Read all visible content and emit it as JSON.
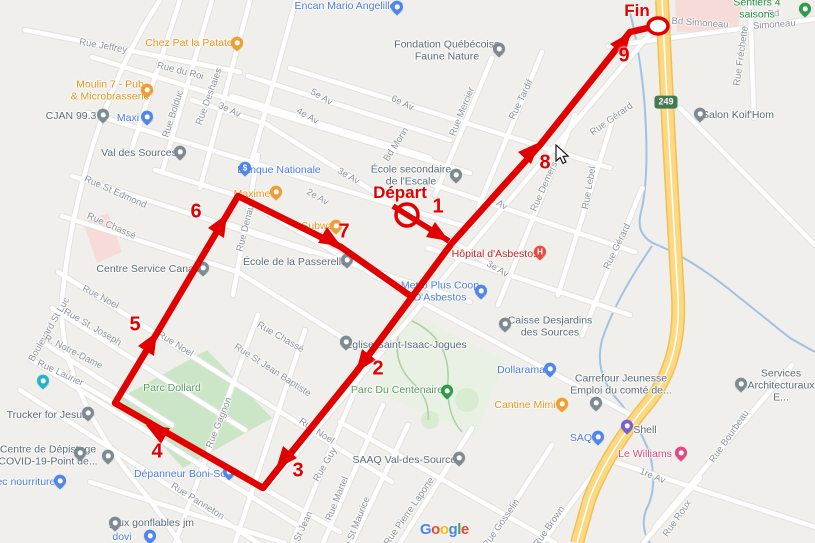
{
  "colors": {
    "land": "#f0efeb",
    "road": "#ffffff",
    "road_casing": "#e4e2de",
    "park": "#cbe6c6",
    "park_pale": "#e8f1e3",
    "trail": "#aecfa5",
    "water": "#9fc2e6",
    "highway": "#fdd880",
    "highway_casing": "#eec158",
    "pink_zone": "#f7dbd8",
    "route_red": "#e10000"
  },
  "route": {
    "start": {
      "label": "Départ",
      "x": 400,
      "y": 193
    },
    "end": {
      "label": "Fin",
      "x": 637,
      "y": 11
    },
    "waypoints": [
      {
        "n": "1",
        "x": 438,
        "y": 207
      },
      {
        "n": "2",
        "x": 378,
        "y": 369
      },
      {
        "n": "3",
        "x": 298,
        "y": 471
      },
      {
        "n": "4",
        "x": 157,
        "y": 452
      },
      {
        "n": "5",
        "x": 135,
        "y": 325
      },
      {
        "n": "6",
        "x": 196,
        "y": 212
      },
      {
        "n": "7",
        "x": 344,
        "y": 232
      },
      {
        "n": "8",
        "x": 545,
        "y": 163
      },
      {
        "n": "9",
        "x": 624,
        "y": 56
      }
    ]
  },
  "highway_shield": {
    "text": "249"
  },
  "attribution": {
    "letters": [
      {
        "ch": "G",
        "color": "#4285F4"
      },
      {
        "ch": "o",
        "color": "#EA4335"
      },
      {
        "ch": "o",
        "color": "#FBBC05"
      },
      {
        "ch": "g",
        "color": "#4285F4"
      },
      {
        "ch": "l",
        "color": "#34A853"
      },
      {
        "ch": "e",
        "color": "#EA4335"
      }
    ]
  },
  "markers": [
    {
      "name": "encan-mario-angelillo",
      "x": 397,
      "y": 9,
      "color": "#4e86ec",
      "glyph": ""
    },
    {
      "name": "chez-pat-la-patate",
      "x": 237,
      "y": 45,
      "color": "#f09e2e",
      "glyph": ""
    },
    {
      "name": "moulin-7-pub",
      "x": 147,
      "y": 92,
      "color": "#f09e2e",
      "glyph": ""
    },
    {
      "name": "cjan-99-3",
      "x": 103,
      "y": 117,
      "color": "#7b8a93",
      "glyph": ""
    },
    {
      "name": "maxi",
      "x": 147,
      "y": 119,
      "color": "#4e86ec",
      "glyph": ""
    },
    {
      "name": "val-des-sources",
      "x": 180,
      "y": 154,
      "color": "#7b8a93",
      "glyph": ""
    },
    {
      "name": "fondation-quebecoise-faune-nature",
      "x": 499,
      "y": 51,
      "color": "#7b8a93",
      "glyph": ""
    },
    {
      "name": "sentiers-4-saisons",
      "x": 805,
      "y": 11,
      "color": "#2c9c47",
      "glyph": ""
    },
    {
      "name": "salon-koif-hom",
      "x": 700,
      "y": 116,
      "color": "#7b8a93",
      "glyph": ""
    },
    {
      "name": "ecole-secondaire-de-l-escale",
      "x": 456,
      "y": 177,
      "color": "#7b8a93",
      "glyph": ""
    },
    {
      "name": "banque-nationale",
      "x": 245,
      "y": 170,
      "color": "#4e86ec",
      "glyph": "$"
    },
    {
      "name": "maxime",
      "x": 276,
      "y": 194,
      "color": "#f09e2e",
      "glyph": ""
    },
    {
      "name": "subway",
      "x": 336,
      "y": 228,
      "color": "#f09e2e",
      "glyph": ""
    },
    {
      "name": "ecole-de-la-passerelle",
      "x": 347,
      "y": 262,
      "color": "#7b8a93",
      "glyph": ""
    },
    {
      "name": "hopital-d-asbestos",
      "x": 540,
      "y": 254,
      "color": "#ea4a3f",
      "glyph": "H"
    },
    {
      "name": "metro-plus-coop",
      "x": 481,
      "y": 293,
      "color": "#4e86ec",
      "glyph": ""
    },
    {
      "name": "centre-service-canada",
      "x": 203,
      "y": 270,
      "color": "#7b8a93",
      "glyph": ""
    },
    {
      "name": "caisse-desjardins-des-sources",
      "x": 505,
      "y": 326,
      "color": "#7b8a93",
      "glyph": ""
    },
    {
      "name": "dollarama",
      "x": 550,
      "y": 371,
      "color": "#4e86ec",
      "glyph": ""
    },
    {
      "name": "carrefour-jeunesse-emploi",
      "x": 596,
      "y": 405,
      "color": "#7b8a93",
      "glyph": ""
    },
    {
      "name": "cantine-mimi",
      "x": 562,
      "y": 406,
      "color": "#f09e2e",
      "glyph": ""
    },
    {
      "name": "saq",
      "x": 598,
      "y": 439,
      "color": "#4e86ec",
      "glyph": ""
    },
    {
      "name": "shell",
      "x": 627,
      "y": 428,
      "color": "#7460d1",
      "glyph": ""
    },
    {
      "name": "le-williams",
      "x": 681,
      "y": 455,
      "color": "#e5477f",
      "glyph": ""
    },
    {
      "name": "services-architecturaux",
      "x": 741,
      "y": 386,
      "color": "#7b8a93",
      "glyph": ""
    },
    {
      "name": "trucker-for-jesus",
      "x": 88,
      "y": 415,
      "color": "#7b8a93",
      "glyph": ""
    },
    {
      "name": "centre-de-depistage-covid",
      "x": 80,
      "y": 455,
      "color": "#7b8a93",
      "glyph": ""
    },
    {
      "name": "school-unlabeled",
      "x": 108,
      "y": 458,
      "color": "#7b8a93",
      "glyph": ""
    },
    {
      "name": "bec-nourriture",
      "x": 60,
      "y": 483,
      "color": "#4e86ec",
      "glyph": ""
    },
    {
      "name": "depanneur-boni-soir",
      "x": 229,
      "y": 474,
      "color": "#4e86ec",
      "glyph": ""
    },
    {
      "name": "jeux-gonflables-jm",
      "x": 115,
      "y": 525,
      "color": "#7b8a93",
      "glyph": ""
    },
    {
      "name": "dovi",
      "x": 150,
      "y": 538,
      "color": "#4e86ec",
      "glyph": ""
    },
    {
      "name": "unlabeled-teal",
      "x": 43,
      "y": 383,
      "color": "#1fb6c9",
      "glyph": ""
    },
    {
      "name": "saaq-val-des-sources",
      "x": 459,
      "y": 460,
      "color": "#7b8a93",
      "glyph": ""
    },
    {
      "name": "eglise-saint-isaac-jogues",
      "x": 346,
      "y": 344,
      "color": "#7b8a93",
      "glyph": ""
    },
    {
      "name": "parc-du-centenaire-tree",
      "x": 447,
      "y": 393,
      "color": "#2c9c47",
      "glyph": ""
    }
  ],
  "labels": [
    {
      "t": "Rue Jeffrey",
      "x": 103,
      "y": 47,
      "r": 10,
      "c": "street"
    },
    {
      "t": "Rue du Roi",
      "x": 180,
      "y": 72,
      "r": 14,
      "c": "street"
    },
    {
      "t": "Rue Bolduc",
      "x": 174,
      "y": 114,
      "r": -72,
      "c": "street"
    },
    {
      "t": "Rue Deshaies",
      "x": 210,
      "y": 97,
      "r": -70,
      "c": "street"
    },
    {
      "t": "3e Av",
      "x": 229,
      "y": 111,
      "r": 25,
      "c": "street"
    },
    {
      "t": "5e Av",
      "x": 321,
      "y": 98,
      "r": 30,
      "c": "street"
    },
    {
      "t": "4e Av",
      "x": 307,
      "y": 117,
      "r": 30,
      "c": "street"
    },
    {
      "t": "6e Av",
      "x": 402,
      "y": 104,
      "r": 25,
      "c": "street"
    },
    {
      "t": "Bd Morin",
      "x": 397,
      "y": 145,
      "r": -57,
      "c": "street"
    },
    {
      "t": "Rue Mercier",
      "x": 463,
      "y": 112,
      "r": -68,
      "c": "street"
    },
    {
      "t": "Rue Tardif",
      "x": 522,
      "y": 100,
      "r": -64,
      "c": "street"
    },
    {
      "t": "Bd Simoneau",
      "x": 700,
      "y": 24,
      "r": 4,
      "c": "street"
    },
    {
      "t": "Bd Simoneau",
      "x": 774,
      "y": 20,
      "r": -4,
      "c": "street"
    },
    {
      "t": "Rue Fréchette",
      "x": 742,
      "y": 56,
      "r": -82,
      "c": "street"
    },
    {
      "t": "Rue Gérard",
      "x": 612,
      "y": 120,
      "r": -35,
      "c": "street"
    },
    {
      "t": "Rue Gérard",
      "x": 618,
      "y": 247,
      "r": -64,
      "c": "street"
    },
    {
      "t": "Rue Demers",
      "x": 545,
      "y": 187,
      "r": -66,
      "c": "street"
    },
    {
      "t": "Rue Lebel",
      "x": 590,
      "y": 188,
      "r": -80,
      "c": "street"
    },
    {
      "t": "e Av",
      "x": 498,
      "y": 204,
      "r": 30,
      "c": "street"
    },
    {
      "t": "3e Av",
      "x": 348,
      "y": 177,
      "r": 30,
      "c": "street"
    },
    {
      "t": "2e Av",
      "x": 317,
      "y": 198,
      "r": 30,
      "c": "street"
    },
    {
      "t": "3e Av",
      "x": 497,
      "y": 270,
      "r": 30,
      "c": "street"
    },
    {
      "t": "Rue St Edmond",
      "x": 115,
      "y": 193,
      "r": 24,
      "c": "street"
    },
    {
      "t": "Rue Chassé",
      "x": 111,
      "y": 227,
      "r": 24,
      "c": "street"
    },
    {
      "t": "Rue Denault",
      "x": 247,
      "y": 226,
      "r": -76,
      "c": "street"
    },
    {
      "t": "Rue Noel",
      "x": 100,
      "y": 298,
      "r": 28,
      "c": "street"
    },
    {
      "t": "Rue St. Joseph",
      "x": 92,
      "y": 328,
      "r": 30,
      "c": "street"
    },
    {
      "t": "Boulevard St Luc",
      "x": 50,
      "y": 330,
      "r": -60,
      "c": "street"
    },
    {
      "t": "R. Notre-Dame",
      "x": 73,
      "y": 353,
      "r": 27,
      "c": "street"
    },
    {
      "t": "Rue Laurier",
      "x": 60,
      "y": 374,
      "r": 25,
      "c": "street"
    },
    {
      "t": "Rue Noel",
      "x": 175,
      "y": 345,
      "r": 32,
      "c": "street"
    },
    {
      "t": "Rue Chassé",
      "x": 280,
      "y": 338,
      "r": 30,
      "c": "street"
    },
    {
      "t": "Rue St Jean Baptiste",
      "x": 272,
      "y": 371,
      "r": 33,
      "c": "street"
    },
    {
      "t": "Rue Gagnon",
      "x": 220,
      "y": 423,
      "r": -68,
      "c": "street"
    },
    {
      "t": "Rue Noel",
      "x": 316,
      "y": 432,
      "r": 33,
      "c": "street"
    },
    {
      "t": "Rue Guy",
      "x": 326,
      "y": 465,
      "r": -60,
      "c": "street"
    },
    {
      "t": "Rue Martel",
      "x": 338,
      "y": 499,
      "r": -68,
      "c": "street"
    },
    {
      "t": "Rue St Maurice",
      "x": 356,
      "y": 528,
      "r": -68,
      "c": "street"
    },
    {
      "t": "Rue Pierre Laporte",
      "x": 410,
      "y": 512,
      "r": -55,
      "c": "street"
    },
    {
      "t": "Rue Panneton",
      "x": 197,
      "y": 502,
      "r": 32,
      "c": "street"
    },
    {
      "t": "1re Av",
      "x": 652,
      "y": 477,
      "r": 22,
      "c": "street"
    },
    {
      "t": "Rue Roux",
      "x": 678,
      "y": 519,
      "r": -55,
      "c": "street"
    },
    {
      "t": "Rue Bourbeau",
      "x": 730,
      "y": 437,
      "r": -55,
      "c": "street"
    },
    {
      "t": "Rue Gosselin",
      "x": 502,
      "y": 524,
      "r": -55,
      "c": "street"
    },
    {
      "t": "Rue Brown",
      "x": 550,
      "y": 527,
      "r": -55,
      "c": "street"
    },
    {
      "t": "Rue St Jean",
      "x": 300,
      "y": 536,
      "r": -65,
      "c": "street"
    },
    {
      "t": "Encan Mario Angelillo",
      "x": 345,
      "y": 7,
      "r": 0,
      "c": "shop"
    },
    {
      "t": "Chez Pat la Patate",
      "x": 189,
      "y": 44,
      "r": 0,
      "c": "food"
    },
    {
      "t": "Moulin 7 - Pub\n& Microbrasserie",
      "x": 110,
      "y": 91,
      "r": 0,
      "c": "food"
    },
    {
      "t": "CJAN 99.3",
      "x": 71,
      "y": 117,
      "r": 0,
      "c": "poi"
    },
    {
      "t": "Maxi",
      "x": 128,
      "y": 119,
      "r": 0,
      "c": "shop"
    },
    {
      "t": "Val des Sources",
      "x": 139,
      "y": 154,
      "r": 0,
      "c": "poi"
    },
    {
      "t": "Fondation Québécoise\nFaune Nature",
      "x": 447,
      "y": 51,
      "r": 0,
      "c": "poi"
    },
    {
      "t": "Sentiers 4 saisons",
      "x": 757,
      "y": 9,
      "r": 0,
      "c": "green"
    },
    {
      "t": "Salon Koif'Hom",
      "x": 738,
      "y": 116,
      "r": 0,
      "c": "poi"
    },
    {
      "t": "École secondaire\nde l'Escale",
      "x": 411,
      "y": 176,
      "r": 0,
      "c": "poi"
    },
    {
      "t": "Banque Nationale",
      "x": 279,
      "y": 171,
      "r": 0,
      "c": "shop"
    },
    {
      "t": "Maxime",
      "x": 252,
      "y": 195,
      "r": 0,
      "c": "food"
    },
    {
      "t": "Subway",
      "x": 320,
      "y": 227,
      "r": 0,
      "c": "food"
    },
    {
      "t": "École de la Passerelle",
      "x": 295,
      "y": 263,
      "r": 0,
      "c": "poi"
    },
    {
      "t": "Hôpital d'Asbestos",
      "x": 495,
      "y": 255,
      "r": 0,
      "c": "hospital"
    },
    {
      "t": "Metro Plus Coop\nD'Asbestos",
      "x": 440,
      "y": 292,
      "r": 0,
      "c": "shop"
    },
    {
      "t": "Centre Service Canada",
      "x": 151,
      "y": 270,
      "r": 0,
      "c": "poi"
    },
    {
      "t": "Caisse Desjardins\ndes Sources",
      "x": 550,
      "y": 327,
      "r": 0,
      "c": "poi"
    },
    {
      "t": "Dollarama",
      "x": 521,
      "y": 371,
      "r": 0,
      "c": "shop"
    },
    {
      "t": "Carrefour Jeunesse\nEmploi du comté de...",
      "x": 621,
      "y": 385,
      "r": 0,
      "c": "poi"
    },
    {
      "t": "Cantine Mimi",
      "x": 525,
      "y": 406,
      "r": 0,
      "c": "food"
    },
    {
      "t": "SAQ",
      "x": 581,
      "y": 439,
      "r": 0,
      "c": "shop"
    },
    {
      "t": "Shell",
      "x": 645,
      "y": 431,
      "r": 0,
      "c": "poi"
    },
    {
      "t": "Le Williams",
      "x": 645,
      "y": 455,
      "r": 0,
      "c": "hotel"
    },
    {
      "t": "Services\nArchitecturaux E...",
      "x": 781,
      "y": 386,
      "r": 0,
      "c": "poi"
    },
    {
      "t": "Trucker for Jesus",
      "x": 47,
      "y": 416,
      "r": 0,
      "c": "poi"
    },
    {
      "t": "Centre de Dépistage\nCOVID-19-Point de...",
      "x": 48,
      "y": 456,
      "r": 0,
      "c": "poi"
    },
    {
      "t": "bec nourriture",
      "x": 23,
      "y": 483,
      "r": 0,
      "c": "shop"
    },
    {
      "t": "Dépanneur Boni-Soir",
      "x": 183,
      "y": 475,
      "r": 0,
      "c": "shop"
    },
    {
      "t": "jeux gonflables jm",
      "x": 152,
      "y": 524,
      "r": 0,
      "c": "poi"
    },
    {
      "t": "dovi",
      "x": 122,
      "y": 538,
      "r": 0,
      "c": "shop"
    },
    {
      "t": "Église Saint-Isaac-Jogues",
      "x": 406,
      "y": 346,
      "r": 0,
      "c": "poi"
    },
    {
      "t": "SAAQ Val-des-Sources",
      "x": 407,
      "y": 461,
      "r": 0,
      "c": "poi"
    },
    {
      "t": "Parc Dollard",
      "x": 172,
      "y": 389,
      "r": 0,
      "c": "park"
    },
    {
      "t": "Parc Du Centenaire",
      "x": 397,
      "y": 391,
      "r": 0,
      "c": "park"
    }
  ]
}
